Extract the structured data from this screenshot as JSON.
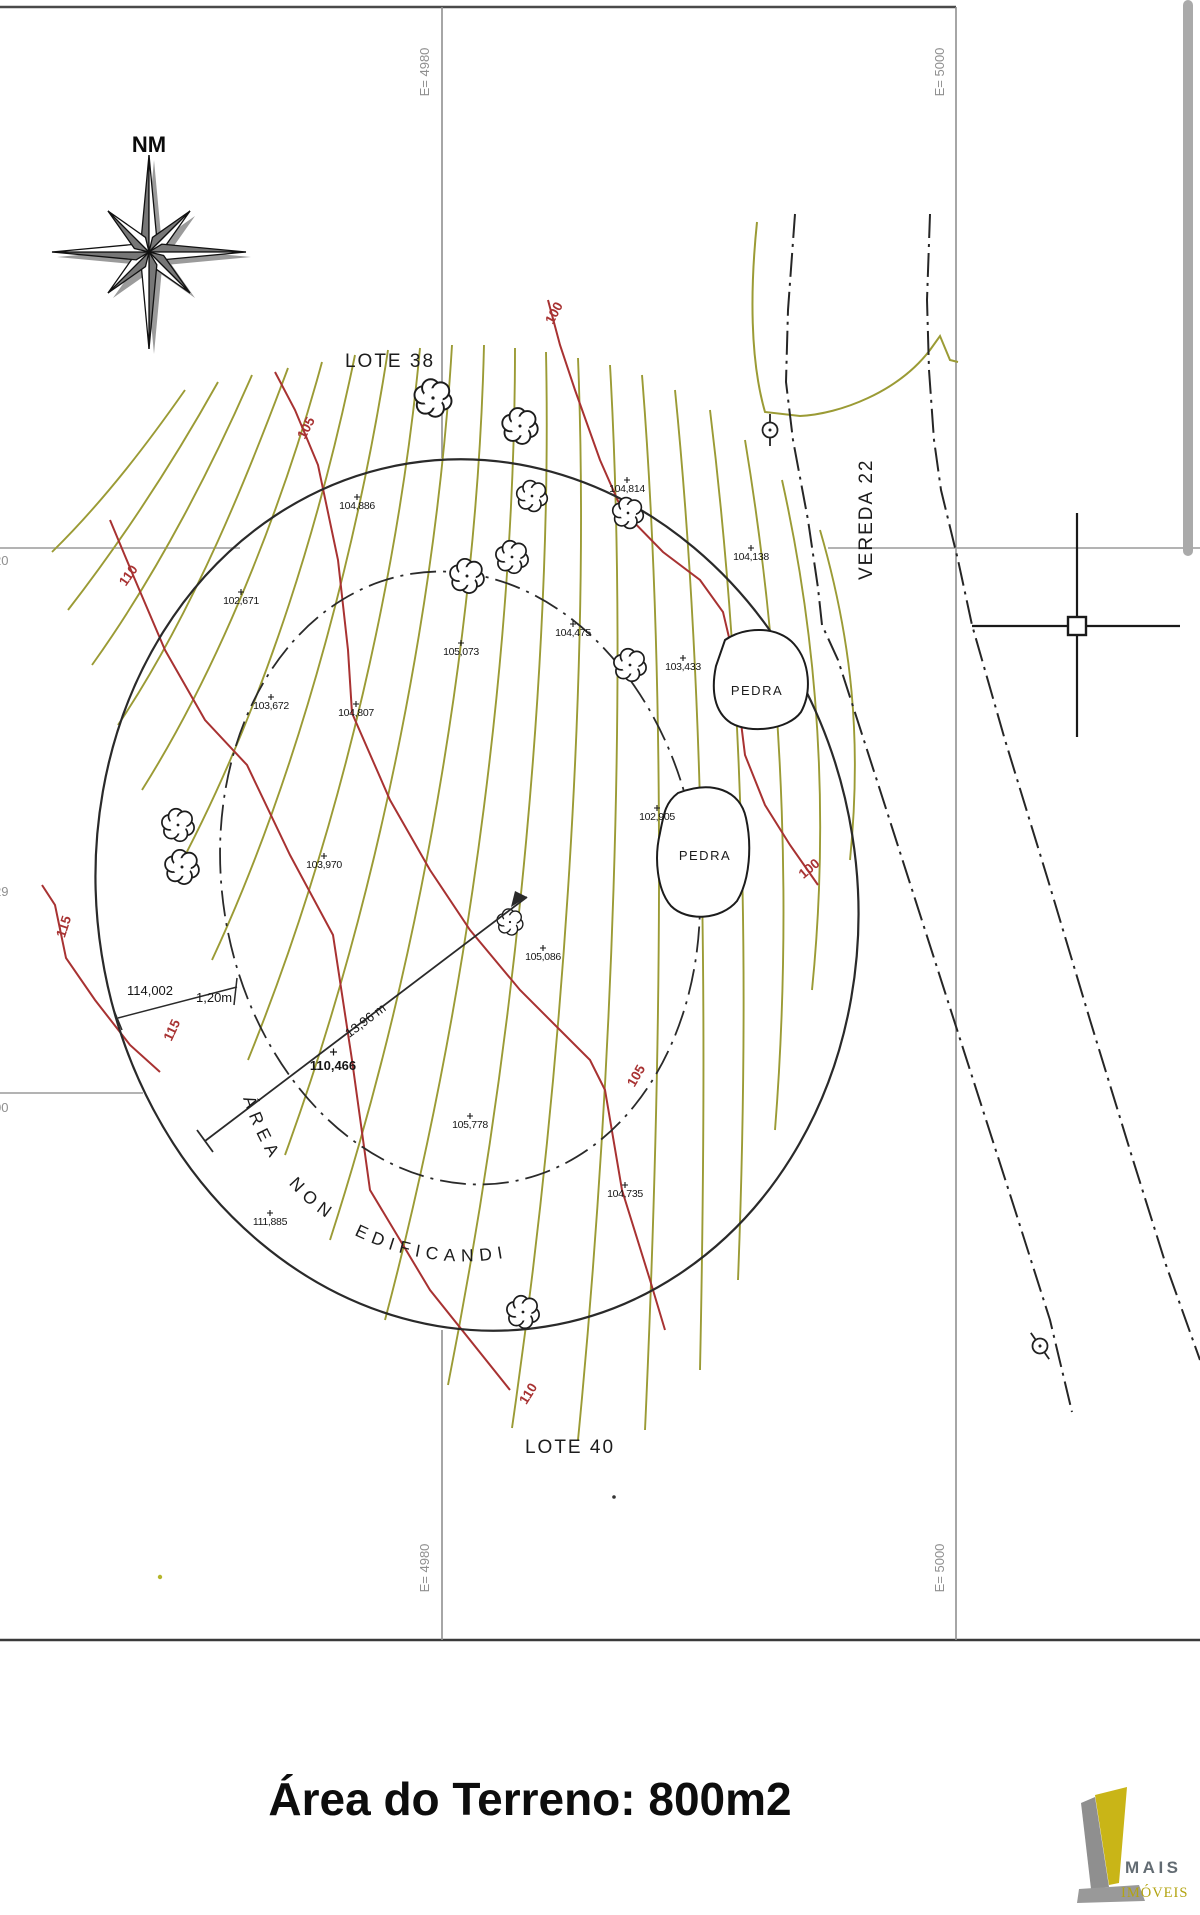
{
  "map": {
    "north_arrow_label": "NM",
    "grid_labels": {
      "top_left": "E= 4980",
      "top_right": "E= 5000",
      "bottom_left": "E= 4980",
      "bottom_right": "E= 5000",
      "left_edge_cut": [
        {
          "text": "20",
          "y": 565
        },
        {
          "text": "29",
          "y": 896
        },
        {
          "text": "00",
          "y": 1112
        }
      ]
    },
    "lots": {
      "top": "LOTE 38",
      "bottom": "LOTE 40"
    },
    "street_name": "VEREDA 22",
    "restriction_text": "ÁREA NON EDIFICANDI",
    "rock_labels": [
      {
        "text": "PEDRA",
        "x": 757,
        "y": 690
      },
      {
        "text": "PEDRA",
        "x": 705,
        "y": 855
      }
    ],
    "contour_index_labels": [
      {
        "text": "100",
        "x": 558,
        "y": 315,
        "rot": -62
      },
      {
        "text": "105",
        "x": 310,
        "y": 430,
        "rot": -62
      },
      {
        "text": "110",
        "x": 132,
        "y": 578,
        "rot": -55
      },
      {
        "text": "115",
        "x": 68,
        "y": 928,
        "rot": -72
      },
      {
        "text": "115",
        "x": 176,
        "y": 1032,
        "rot": -65
      },
      {
        "text": "110",
        "x": 532,
        "y": 1396,
        "rot": -58
      },
      {
        "text": "105",
        "x": 640,
        "y": 1078,
        "rot": -60
      },
      {
        "text": "100",
        "x": 812,
        "y": 872,
        "rot": -40
      }
    ],
    "spot_elevations": [
      {
        "text": "104,886",
        "x": 357,
        "y": 509
      },
      {
        "text": "102,671",
        "x": 241,
        "y": 604
      },
      {
        "text": "103,672",
        "x": 271,
        "y": 709
      },
      {
        "text": "104,807",
        "x": 356,
        "y": 716
      },
      {
        "text": "105,073",
        "x": 461,
        "y": 655
      },
      {
        "text": "104,475",
        "x": 573,
        "y": 636
      },
      {
        "text": "104,814",
        "x": 627,
        "y": 492
      },
      {
        "text": "104,138",
        "x": 751,
        "y": 560
      },
      {
        "text": "103,433",
        "x": 683,
        "y": 670
      },
      {
        "text": "102,905",
        "x": 657,
        "y": 820
      },
      {
        "text": "103,970",
        "x": 324,
        "y": 868
      },
      {
        "text": "105,086",
        "x": 543,
        "y": 960
      },
      {
        "text": "105,778",
        "x": 470,
        "y": 1128
      },
      {
        "text": "111,885",
        "x": 270,
        "y": 1225
      },
      {
        "text": "104,735",
        "x": 625,
        "y": 1197
      }
    ],
    "dimensions": {
      "center_value": "110,466",
      "line_length": "13,96 m",
      "left_value": "114,002",
      "left_small": "1,20m"
    }
  },
  "footer": {
    "title": "Área do Terreno: 800m2"
  },
  "logo": {
    "line1": "MAIS",
    "line2": "IMÓVEIS"
  },
  "colors": {
    "contour_intermediate": "#9b9b35",
    "contour_index": "#a83232",
    "ink": "#222222",
    "grid_gray": "#949494",
    "logo_yellow": "#c9b517",
    "logo_gray": "#8f8f8f"
  }
}
